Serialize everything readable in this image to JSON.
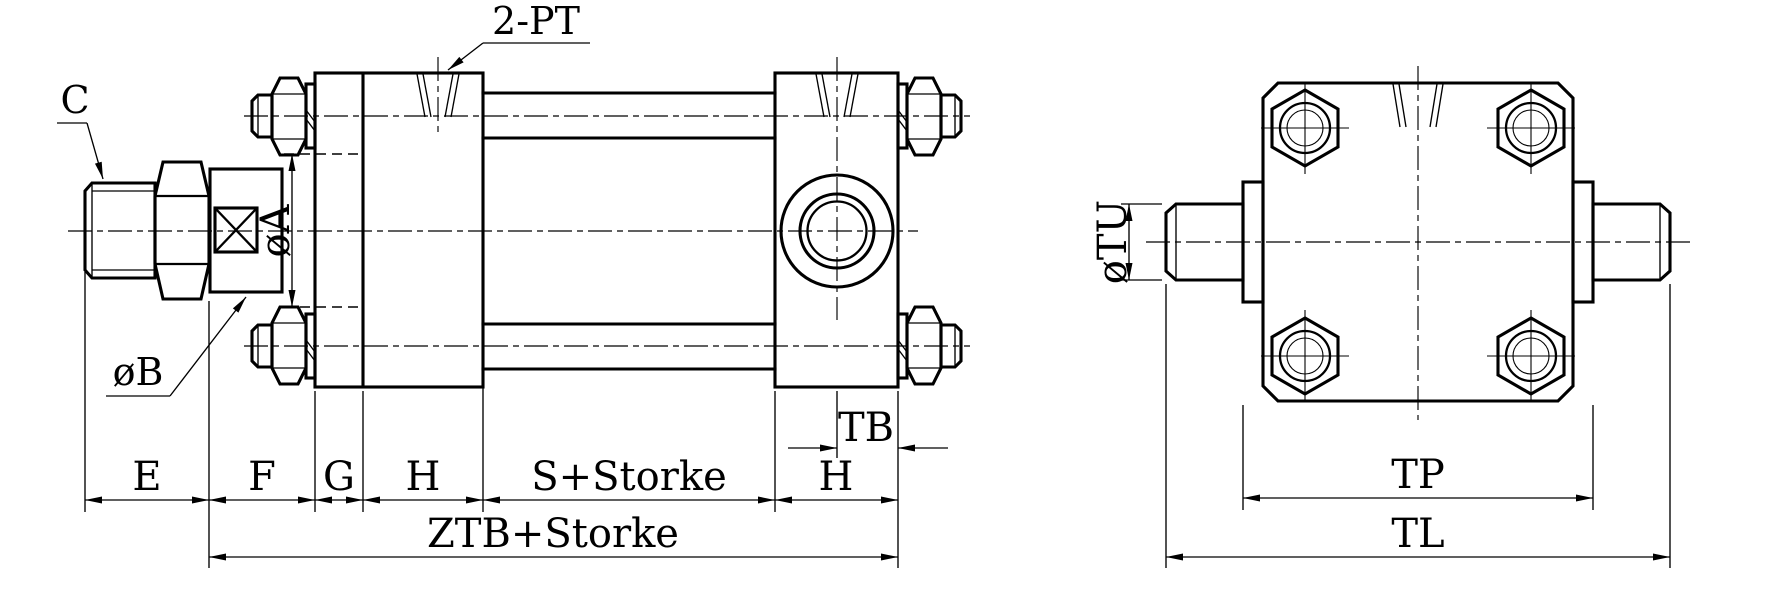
{
  "drawing": {
    "description": "Tie-rod hydraulic cylinder outline drawing, side view and trunnion end view",
    "colors": {
      "line": "#000000",
      "background": "#ffffff"
    },
    "side_view": {
      "callouts": {
        "rod_thread": "C",
        "flange_diameter": "øB",
        "boss_diameter": "øA",
        "ports": "2-PT"
      },
      "dimensions": {
        "e": "E",
        "f": "F",
        "g": "G",
        "h_head": "H",
        "s_stroke": "S+Storke",
        "h_cap": "H",
        "tb": "TB",
        "ztb_stroke": "ZTB+Storke"
      }
    },
    "end_view": {
      "callouts": {
        "trunnion_diameter": "øTU"
      },
      "dimensions": {
        "tp": "TP",
        "tl": "TL"
      }
    }
  }
}
